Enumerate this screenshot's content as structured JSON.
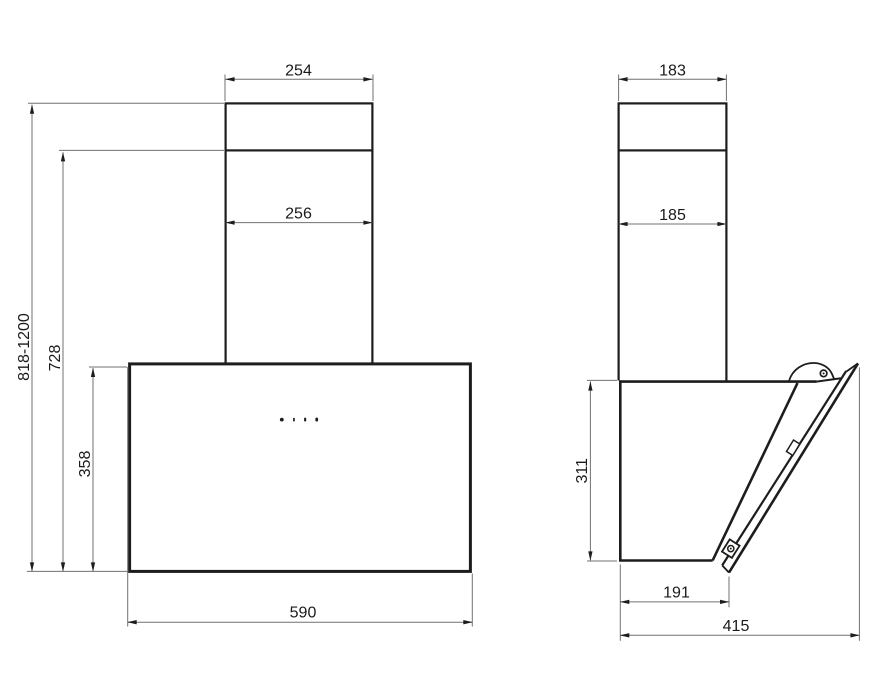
{
  "drawing": {
    "kind": "technical-dimension-drawing",
    "subject": "wall-mounted inclined cooker hood, front and side views",
    "background": "#ffffff",
    "object_line_color": "#1d1d1b",
    "dimension_line_color": "#71716f",
    "front_view": {
      "chimney_top_width": "254",
      "chimney_width": "256",
      "body_width": "590",
      "overall_height_range": "818-1200",
      "chimney_height_from_bottom": "728",
      "body_height": "358"
    },
    "side_view": {
      "chimney_top_depth": "183",
      "chimney_depth": "185",
      "body_height": "311",
      "body_bottom_depth": "191",
      "overall_depth": "415"
    }
  }
}
